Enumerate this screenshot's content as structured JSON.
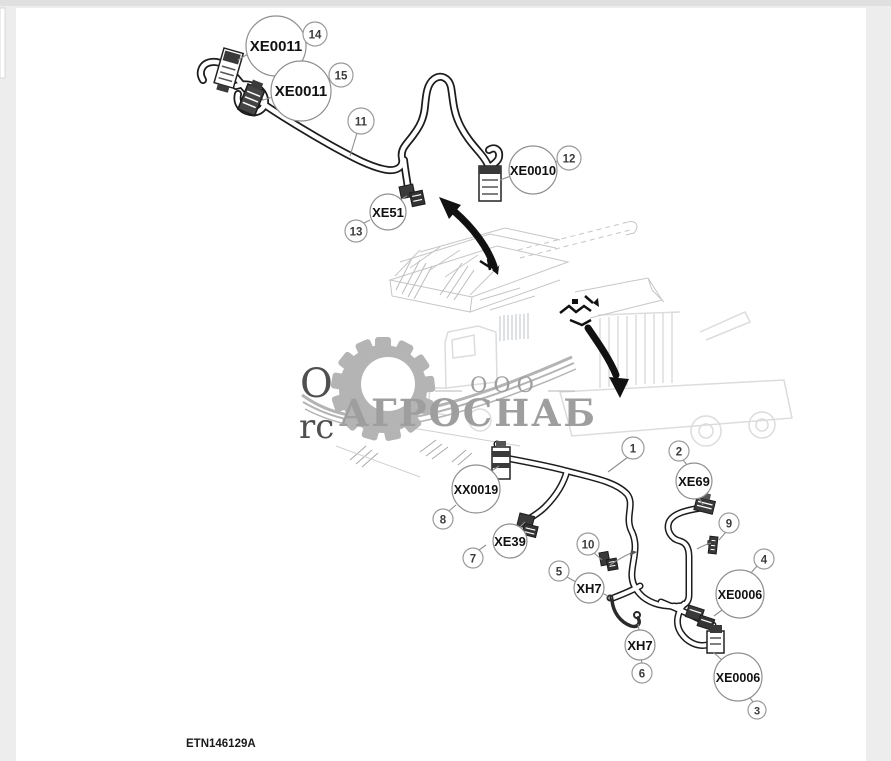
{
  "page": {
    "figure_code": "ETN146129A"
  },
  "watermark": {
    "company_prefix": "ООО",
    "company_name": "АГРОСНАБ",
    "partial_text_top": "O",
    "partial_text_bottom": "rc",
    "gear_icon": "gear-icon",
    "color": "#a6a6a6"
  },
  "colors": {
    "line_art": "#1c1c1c",
    "faint_art": "#c6c6c6",
    "callout_stroke": "#8f8f8f",
    "background": "#ededed",
    "page": "#ffffff"
  },
  "callouts": {
    "c14": {
      "code": "XE0011",
      "num": "14"
    },
    "c15": {
      "code": "XE0011",
      "num": "15"
    },
    "c11": {
      "num": "11"
    },
    "c12": {
      "code": "XE0010",
      "num": "12"
    },
    "c13": {
      "code": "XE51",
      "num": "13"
    },
    "c1": {
      "num": "1"
    },
    "c2": {
      "code": "XE69",
      "num": "2"
    },
    "c8": {
      "code": "XX0019",
      "num": "8"
    },
    "c7": {
      "code": "XE39",
      "num": "7"
    },
    "c10": {
      "num": "10"
    },
    "c5": {
      "code": "XH7",
      "num": "5"
    },
    "c4": {
      "code": "XE0006",
      "num": "4"
    },
    "c6": {
      "code": "XH7",
      "num": "6"
    },
    "c3": {
      "code": "XE0006",
      "num": "3"
    },
    "c9": {
      "num": "9"
    }
  }
}
